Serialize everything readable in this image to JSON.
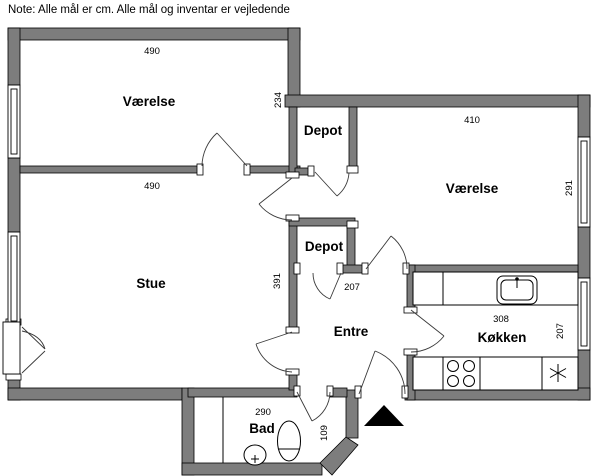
{
  "note": "Note: Alle mål er cm. Alle mål og inventar er vejledende",
  "rooms": {
    "vaerelse_nw": {
      "label": "Værelse",
      "dim_width": "490",
      "dim_height": "234"
    },
    "stue": {
      "label": "Stue",
      "dim_width": "490",
      "dim_height": "391"
    },
    "depot_n": {
      "label": "Depot"
    },
    "depot_s": {
      "label": "Depot"
    },
    "vaerelse_e": {
      "label": "Værelse",
      "dim_width": "410",
      "dim_height": "291"
    },
    "entre": {
      "label": "Entre",
      "dim_width": "207"
    },
    "koekken": {
      "label": "Køkken",
      "dim_width": "308",
      "dim_height": "207"
    },
    "bad": {
      "label": "Bad",
      "dim_width": "290",
      "dim_height": "109"
    }
  },
  "fixtures": [
    "kitchen-sink",
    "stove-burners",
    "appliance-asterisk",
    "toilet",
    "washbasin",
    "shower-divider",
    "entrance-arrow",
    "window",
    "balcony-door"
  ],
  "colors": {
    "wall": "#7d7d7d",
    "wall_outline": "#000000",
    "line": "#3a3a3a",
    "background": "#ffffff",
    "entrance_marker": "#000000"
  }
}
